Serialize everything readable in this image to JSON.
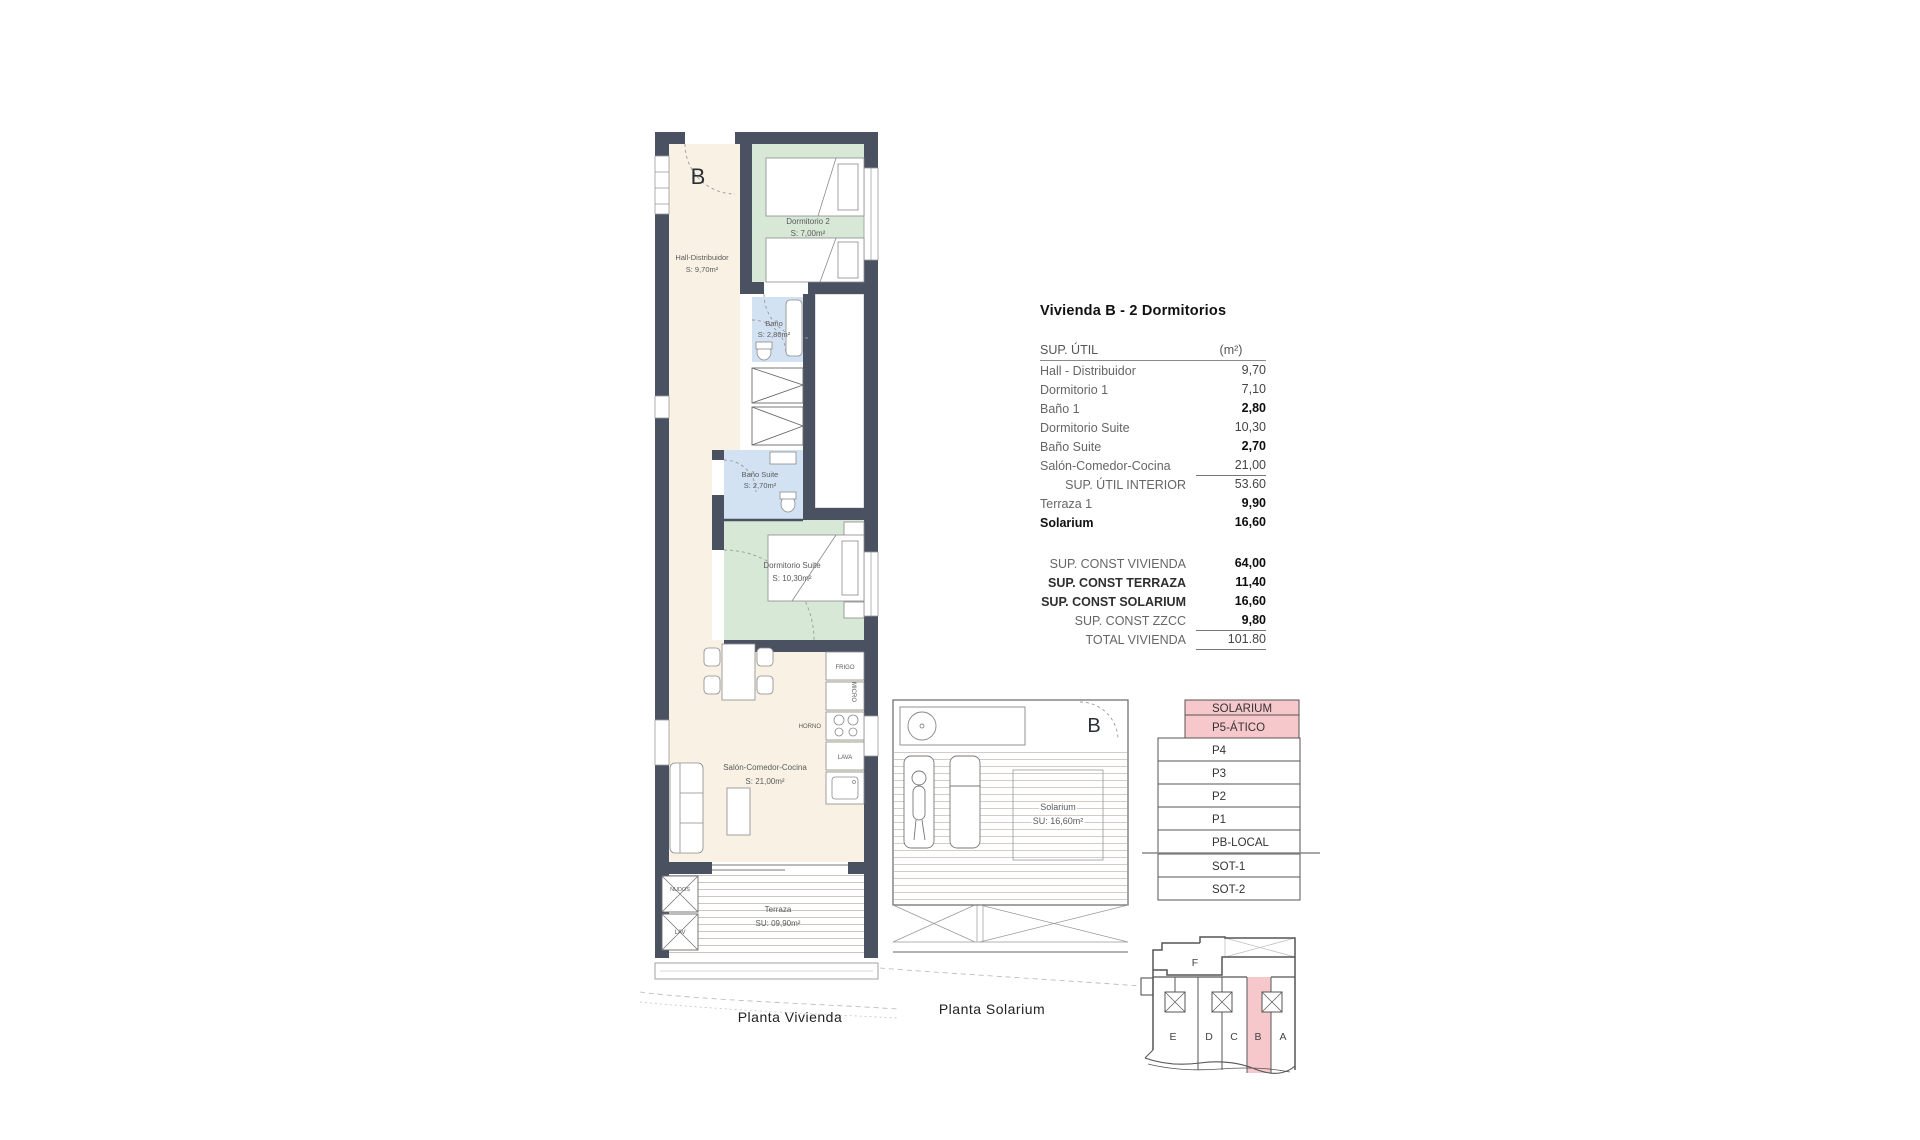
{
  "title": "Vivienda B - 2 Dormitorios",
  "colors": {
    "wall": "#4a5262",
    "floor_cream": "#f9f2e4",
    "bedroom_green": "#d8e8d6",
    "bath_blue": "#d2e2f2",
    "highlight_pink": "#f6c8cc"
  },
  "table": {
    "header": {
      "label": "SUP. ÚTIL",
      "unit": "(m²)"
    },
    "rows": [
      {
        "label": "Hall - Distribuidor",
        "value": "9,70"
      },
      {
        "label": "Dormitorio 1",
        "value": "7,10"
      },
      {
        "label": "Baño 1",
        "value": "2,80",
        "vbold": true
      },
      {
        "label": "Dormitorio Suite",
        "value": "10,30"
      },
      {
        "label": "Baño Suite",
        "value": "2,70",
        "vbold": true
      },
      {
        "label": "Salón-Comedor-Cocina",
        "value": "21,00",
        "vline": true
      },
      {
        "label": "SUP. ÚTIL INTERIOR",
        "value": "53.60",
        "align": "right"
      },
      {
        "label": "Terraza 1",
        "value": "9,90",
        "vbold": true
      },
      {
        "label": "Solarium",
        "value": "16,60",
        "lbold": true,
        "vbold": true
      },
      {
        "gap": true
      },
      {
        "label": "SUP. CONST VIVIENDA",
        "value": "64,00",
        "align": "right",
        "vbold": true
      },
      {
        "label": "SUP. CONST TERRAZA",
        "value": "11,40",
        "align": "right",
        "ldark": true,
        "vbold": true
      },
      {
        "label": "SUP. CONST SOLARIUM",
        "value": "16,60",
        "align": "right",
        "ldark": true,
        "vbold": true
      },
      {
        "label": "SUP. CONST ZZCC",
        "value": "9,80",
        "align": "right",
        "vbold": true,
        "vline": true
      },
      {
        "label": "TOTAL VIVIENDA",
        "value": "101.80",
        "align": "right",
        "vline": true
      }
    ]
  },
  "plan": {
    "letter": "B",
    "caption": "Planta Vivienda",
    "rooms": {
      "hall": {
        "name": "Hall-Distribuidor",
        "area": "S: 9,70m²"
      },
      "dorm2": {
        "name": "Dormitorio 2",
        "area": "S: 7,00m²"
      },
      "bano1": {
        "name": "Baño",
        "area": "S: 2,80m²"
      },
      "banosuite": {
        "name": "Baño Suite",
        "area": "S: 2,70m²"
      },
      "dormsuite": {
        "name": "Dormitorio Suite",
        "area": "S: 10,30m²"
      },
      "salon": {
        "name": "Salón-Comedor-Cocina",
        "area": "S: 21,00m²"
      },
      "terraza": {
        "name": "Terraza",
        "area": "SU: 09,90m²"
      }
    },
    "kitchen": {
      "frigo": "FRIGO",
      "micro": "MICRO",
      "horno": "HORNO",
      "lava": "LAVA"
    },
    "utility": {
      "nudos": "NUDOS",
      "lav": "LAV"
    }
  },
  "solarium": {
    "letter": "B",
    "caption": "Planta Solarium",
    "name": "Solarium",
    "area": "SU: 16,60m²"
  },
  "levels": {
    "items": [
      {
        "label": "SOLARIUM",
        "highlight": true
      },
      {
        "label": "P5-ÁTICO",
        "highlight": true
      },
      {
        "label": "P4",
        "highlight": false
      },
      {
        "label": "P3",
        "highlight": false
      },
      {
        "label": "P2",
        "highlight": false
      },
      {
        "label": "P1",
        "highlight": false
      },
      {
        "label": "PB-LOCAL",
        "highlight": false
      },
      {
        "label": "SOT-1",
        "highlight": false
      },
      {
        "label": "SOT-2",
        "highlight": false
      }
    ]
  },
  "keyplan": {
    "f_label": "F",
    "units": [
      "E",
      "D",
      "C",
      "B",
      "A"
    ],
    "highlight": "B"
  }
}
